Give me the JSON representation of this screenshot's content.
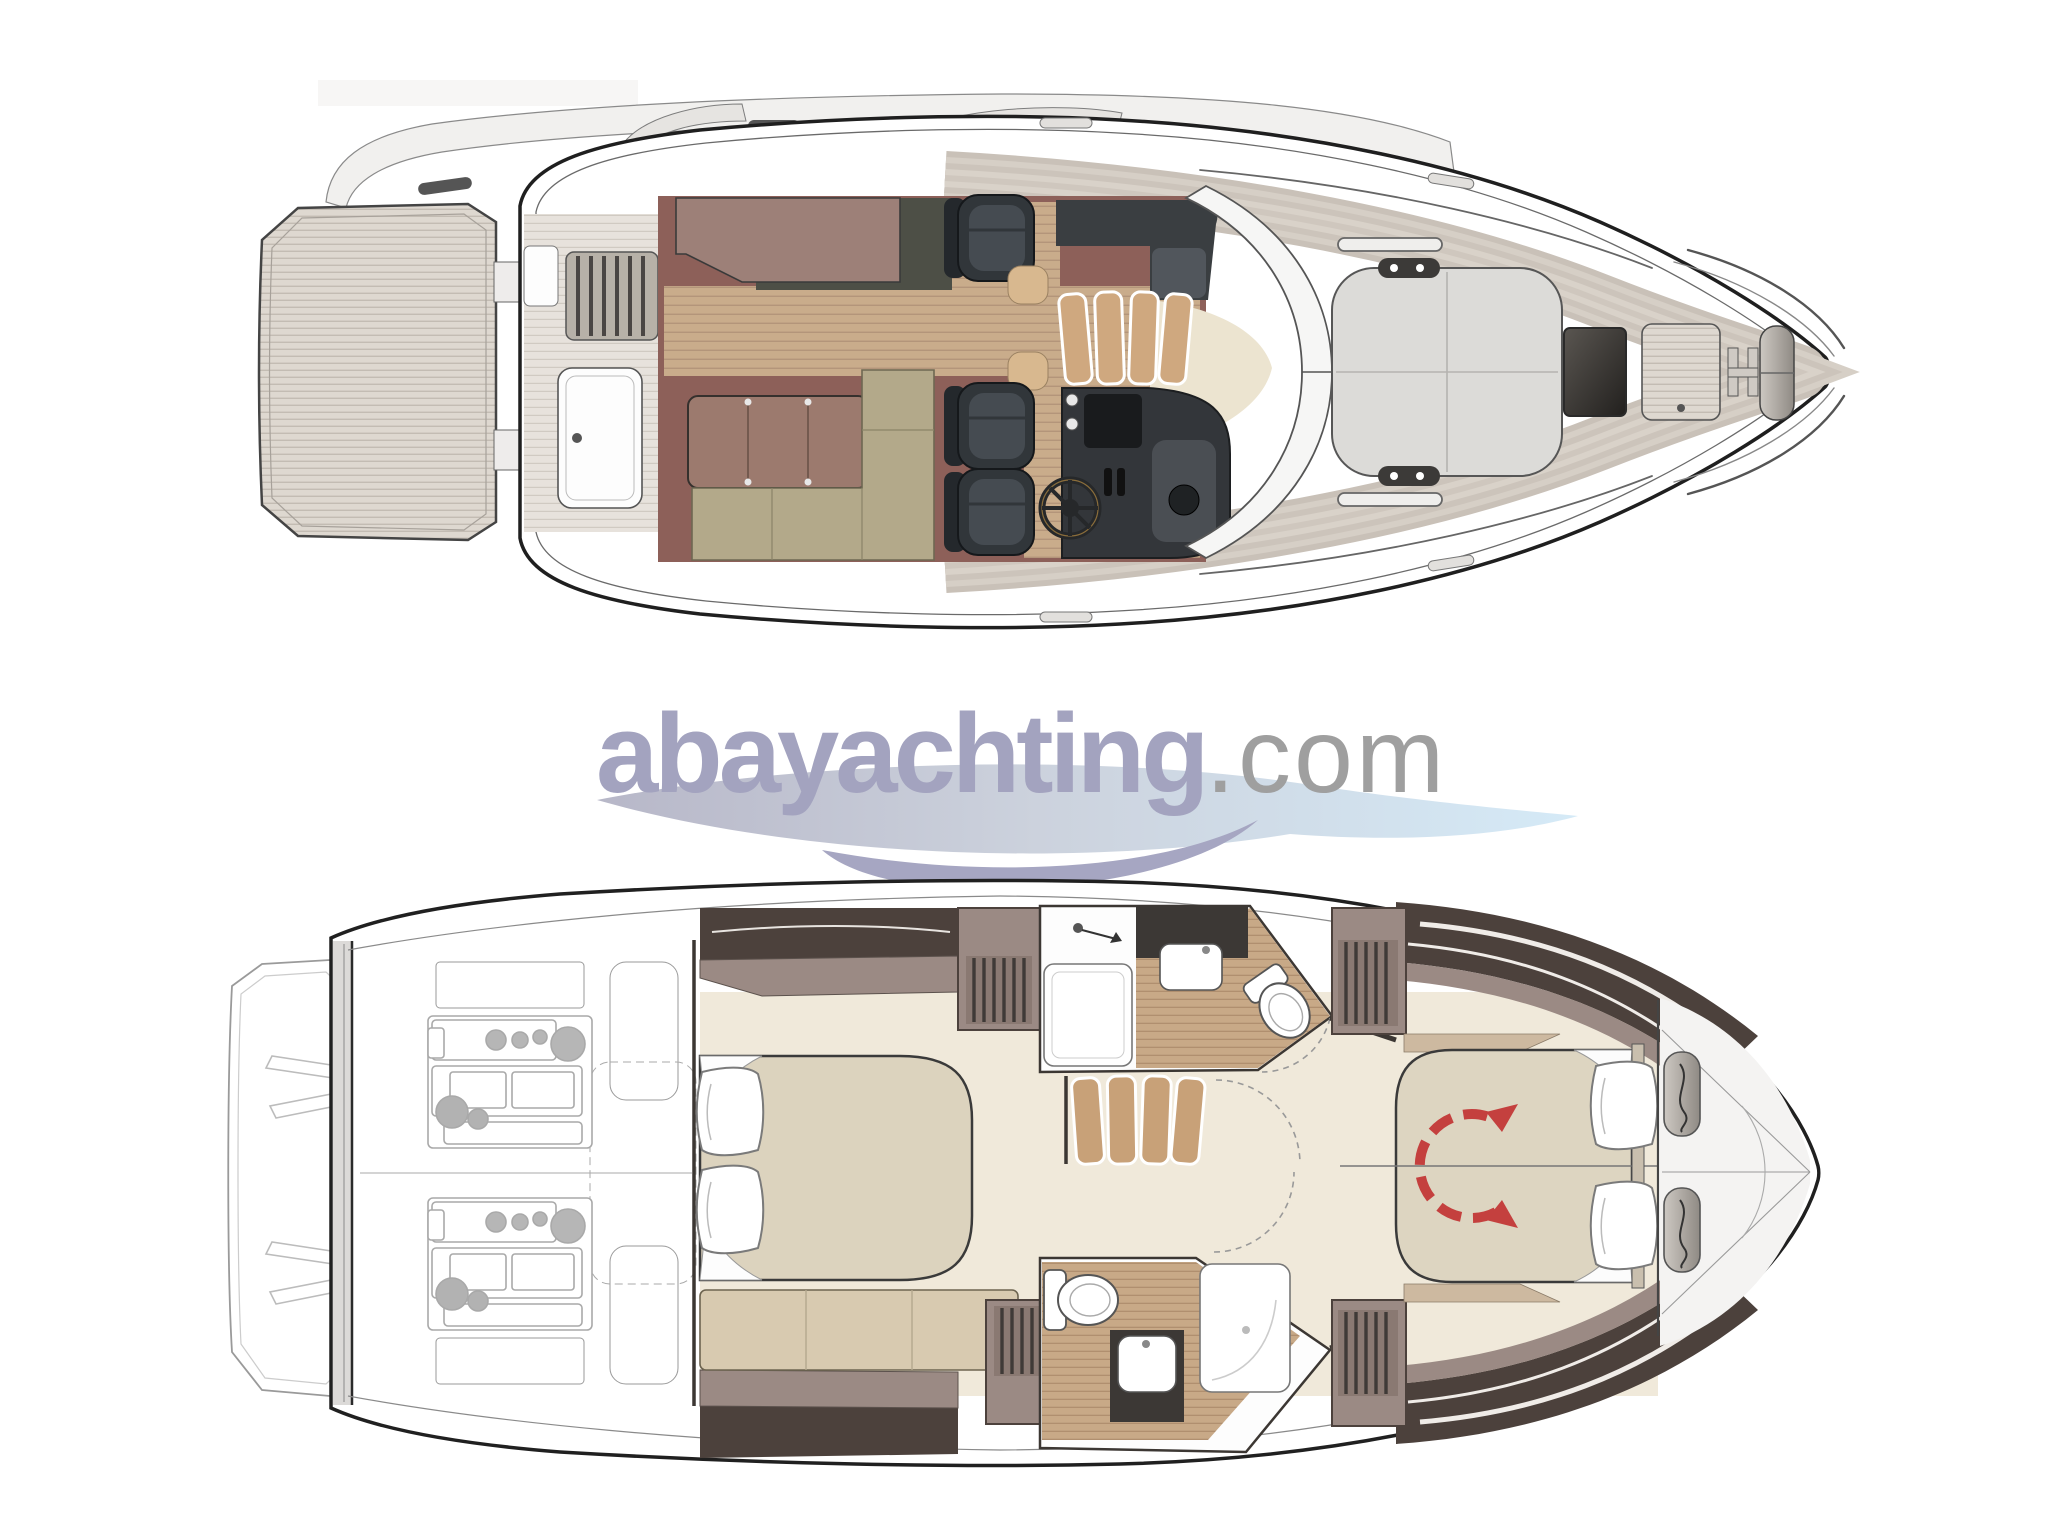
{
  "page": {
    "background": "#ffffff"
  },
  "logo": {
    "brand": "abayachting",
    "tld": ".com",
    "brand_color": "#a3a3bf",
    "tld_color": "#9f9f9f",
    "swoosh_silver": "#b7b7c8",
    "swoosh_blue": "#d5eaf7",
    "swoosh_lavender": "#a6a6c2"
  },
  "diagram": {
    "kind": "yacht floor plans, overhead view",
    "views": [
      {
        "id": "main-deck-plan",
        "position": "top"
      },
      {
        "id": "lower-deck-plan",
        "position": "bottom"
      }
    ],
    "palette": {
      "outline": "#202020",
      "teak_light": "#ded8d0",
      "teak_line": "#c3bcb3",
      "wood_floor": "#c9ac8b",
      "salon_burgundy": "#8d6059",
      "galley_mauve": "#9d8078",
      "galley_dark": "#4d4f46",
      "seat_dark": "#31363a",
      "sofa_olive": "#b3a98a",
      "table_brown": "#9c7a6e",
      "sunpad_gray": "#dcdbd8",
      "cabin_cream": "#f0e9da",
      "bed_beige": "#dcd3be",
      "wall_mauve": "#9b8a84",
      "wall_dark_brown": "#4c413c",
      "counter_dark": "#3c3835",
      "rotation_arrow_red": "#c4403e",
      "engine_line_gray": "#a9a9a9"
    }
  }
}
